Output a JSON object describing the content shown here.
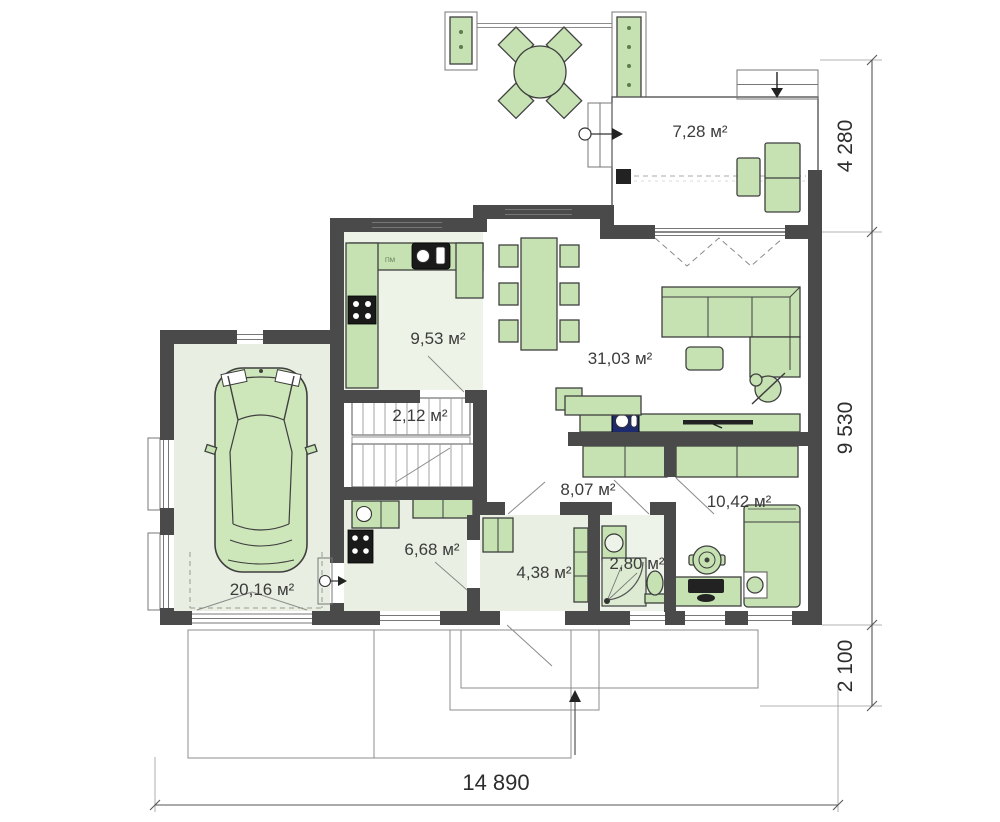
{
  "plan": {
    "rooms": {
      "veranda": {
        "name": "veranda",
        "label": "7,28 м²"
      },
      "kitchen": {
        "name": "kitchen",
        "label": "9,53 м²"
      },
      "living": {
        "name": "living-room",
        "label": "31,03 м²"
      },
      "stairs": {
        "name": "staircase",
        "label": "2,12 м²"
      },
      "hall": {
        "name": "hallway",
        "label": "8,07 м²"
      },
      "bedroom": {
        "name": "bedroom",
        "label": "10,42 м²"
      },
      "garage": {
        "name": "garage",
        "label": "20,16 м²"
      },
      "utility": {
        "name": "utility-room",
        "label": "6,68 м²"
      },
      "entry": {
        "name": "entry-hall",
        "label": "4,38 м²"
      },
      "bath": {
        "name": "bathroom",
        "label": "2,80 м²"
      }
    },
    "appliance_labels": {
      "dishwasher": "ПМ"
    },
    "dimensions": {
      "right_top": "4 280",
      "right_middle": "9 530",
      "right_bottom": "2 100",
      "bottom": "14 890"
    },
    "colors": {
      "wall": "#4a4a4a",
      "furniture_green": "#c6e2b3",
      "floor_tint": "#e9f0e3",
      "fireplace_blue": "#1d2b6e",
      "outline": "#3f3f3f"
    }
  }
}
